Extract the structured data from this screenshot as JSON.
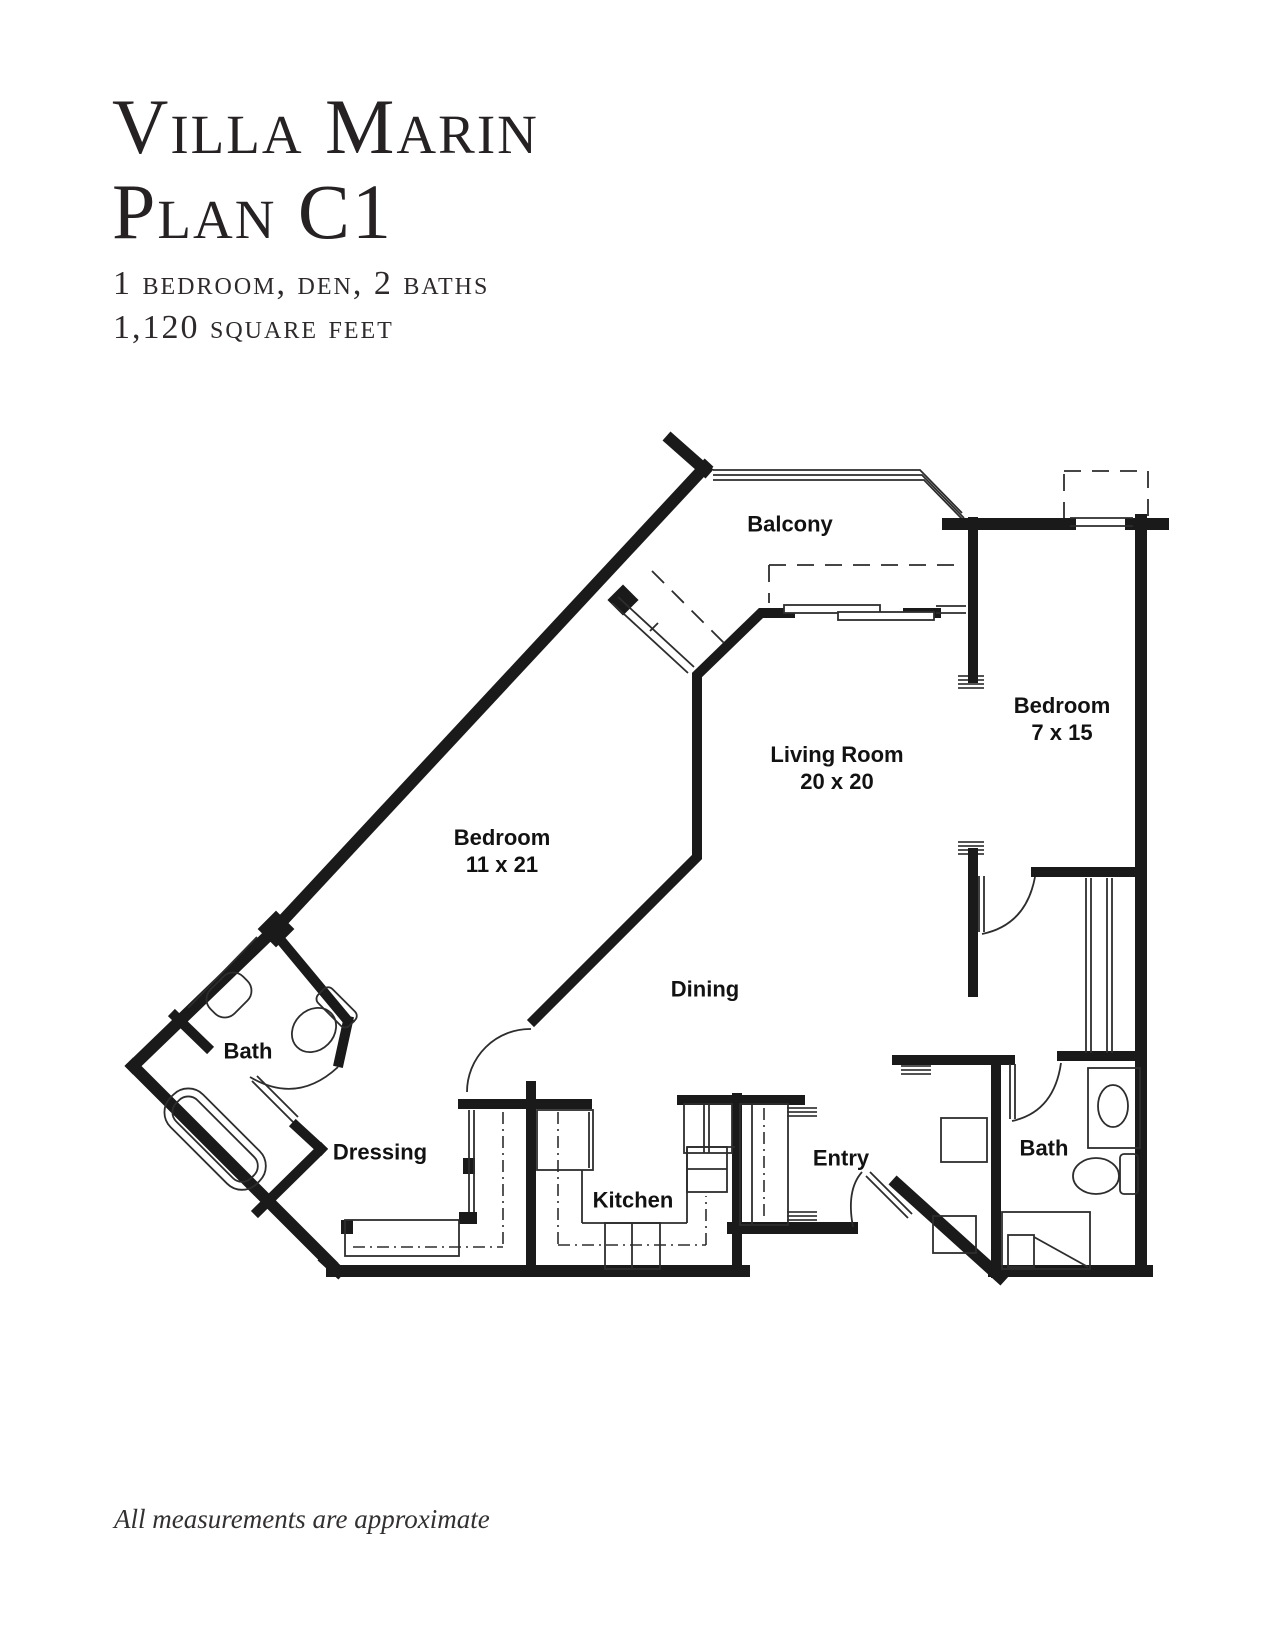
{
  "page": {
    "background": "#ffffff",
    "ink": "#1a1a1a"
  },
  "header": {
    "title_line1": "Villa Marin",
    "title_line2": "Plan C1",
    "subtitle_line1": "1 bedroom, den, 2 baths",
    "subtitle_line2": "1,120 square feet"
  },
  "floor_plan": {
    "rooms": [
      {
        "id": "balcony",
        "label": "Balcony",
        "dim": "",
        "x": 790,
        "y": 524
      },
      {
        "id": "bedroom-den",
        "label": "Bedroom",
        "dim": "7 x 15",
        "x": 1062,
        "y": 706
      },
      {
        "id": "living-room",
        "label": "Living Room",
        "dim": "20 x 20",
        "x": 837,
        "y": 755
      },
      {
        "id": "bedroom-master",
        "label": "Bedroom",
        "dim": "11 x 21",
        "x": 502,
        "y": 838
      },
      {
        "id": "dining",
        "label": "Dining",
        "dim": "",
        "x": 705,
        "y": 989
      },
      {
        "id": "bath-master",
        "label": "Bath",
        "dim": "",
        "x": 248,
        "y": 1051
      },
      {
        "id": "dressing",
        "label": "Dressing",
        "dim": "",
        "x": 380,
        "y": 1152
      },
      {
        "id": "kitchen",
        "label": "Kitchen",
        "dim": "",
        "x": 633,
        "y": 1200
      },
      {
        "id": "entry",
        "label": "Entry",
        "dim": "",
        "x": 841,
        "y": 1158
      },
      {
        "id": "bath-guest",
        "label": "Bath",
        "dim": "",
        "x": 1044,
        "y": 1148
      }
    ]
  },
  "footer": {
    "note": "All measurements are approximate"
  }
}
